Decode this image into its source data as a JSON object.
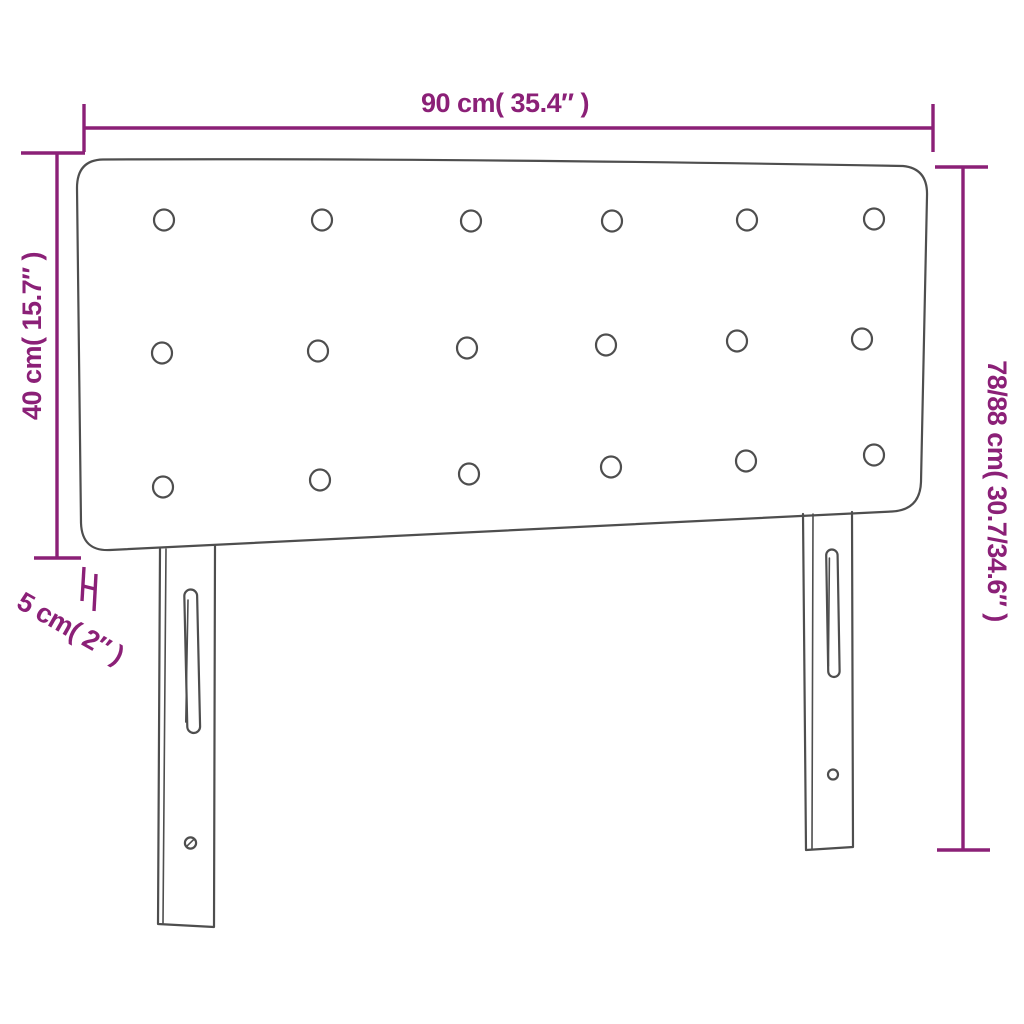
{
  "colors": {
    "dimension": "#8b2077",
    "outline": "#4e4e4e",
    "background": "#ffffff"
  },
  "product": {
    "type": "upholstered headboard with legs",
    "tufting_buttons": {
      "rows": 3,
      "columns": 6,
      "total": 18
    },
    "legs": 2
  },
  "dimensions": {
    "width": {
      "label": "90 cm( 35.4″ )",
      "cm": 90,
      "inches": 35.4
    },
    "headboard_height": {
      "label": "40 cm( 15.7″ )",
      "cm": 40,
      "inches": 15.7
    },
    "depth": {
      "label": "5 cm( 2″ )",
      "cm": 5,
      "inches": 2
    },
    "total_height": {
      "label": "78/88 cm( 30.7/34.6″ )",
      "cm": "78/88",
      "inches": "30.7/34.6"
    }
  }
}
